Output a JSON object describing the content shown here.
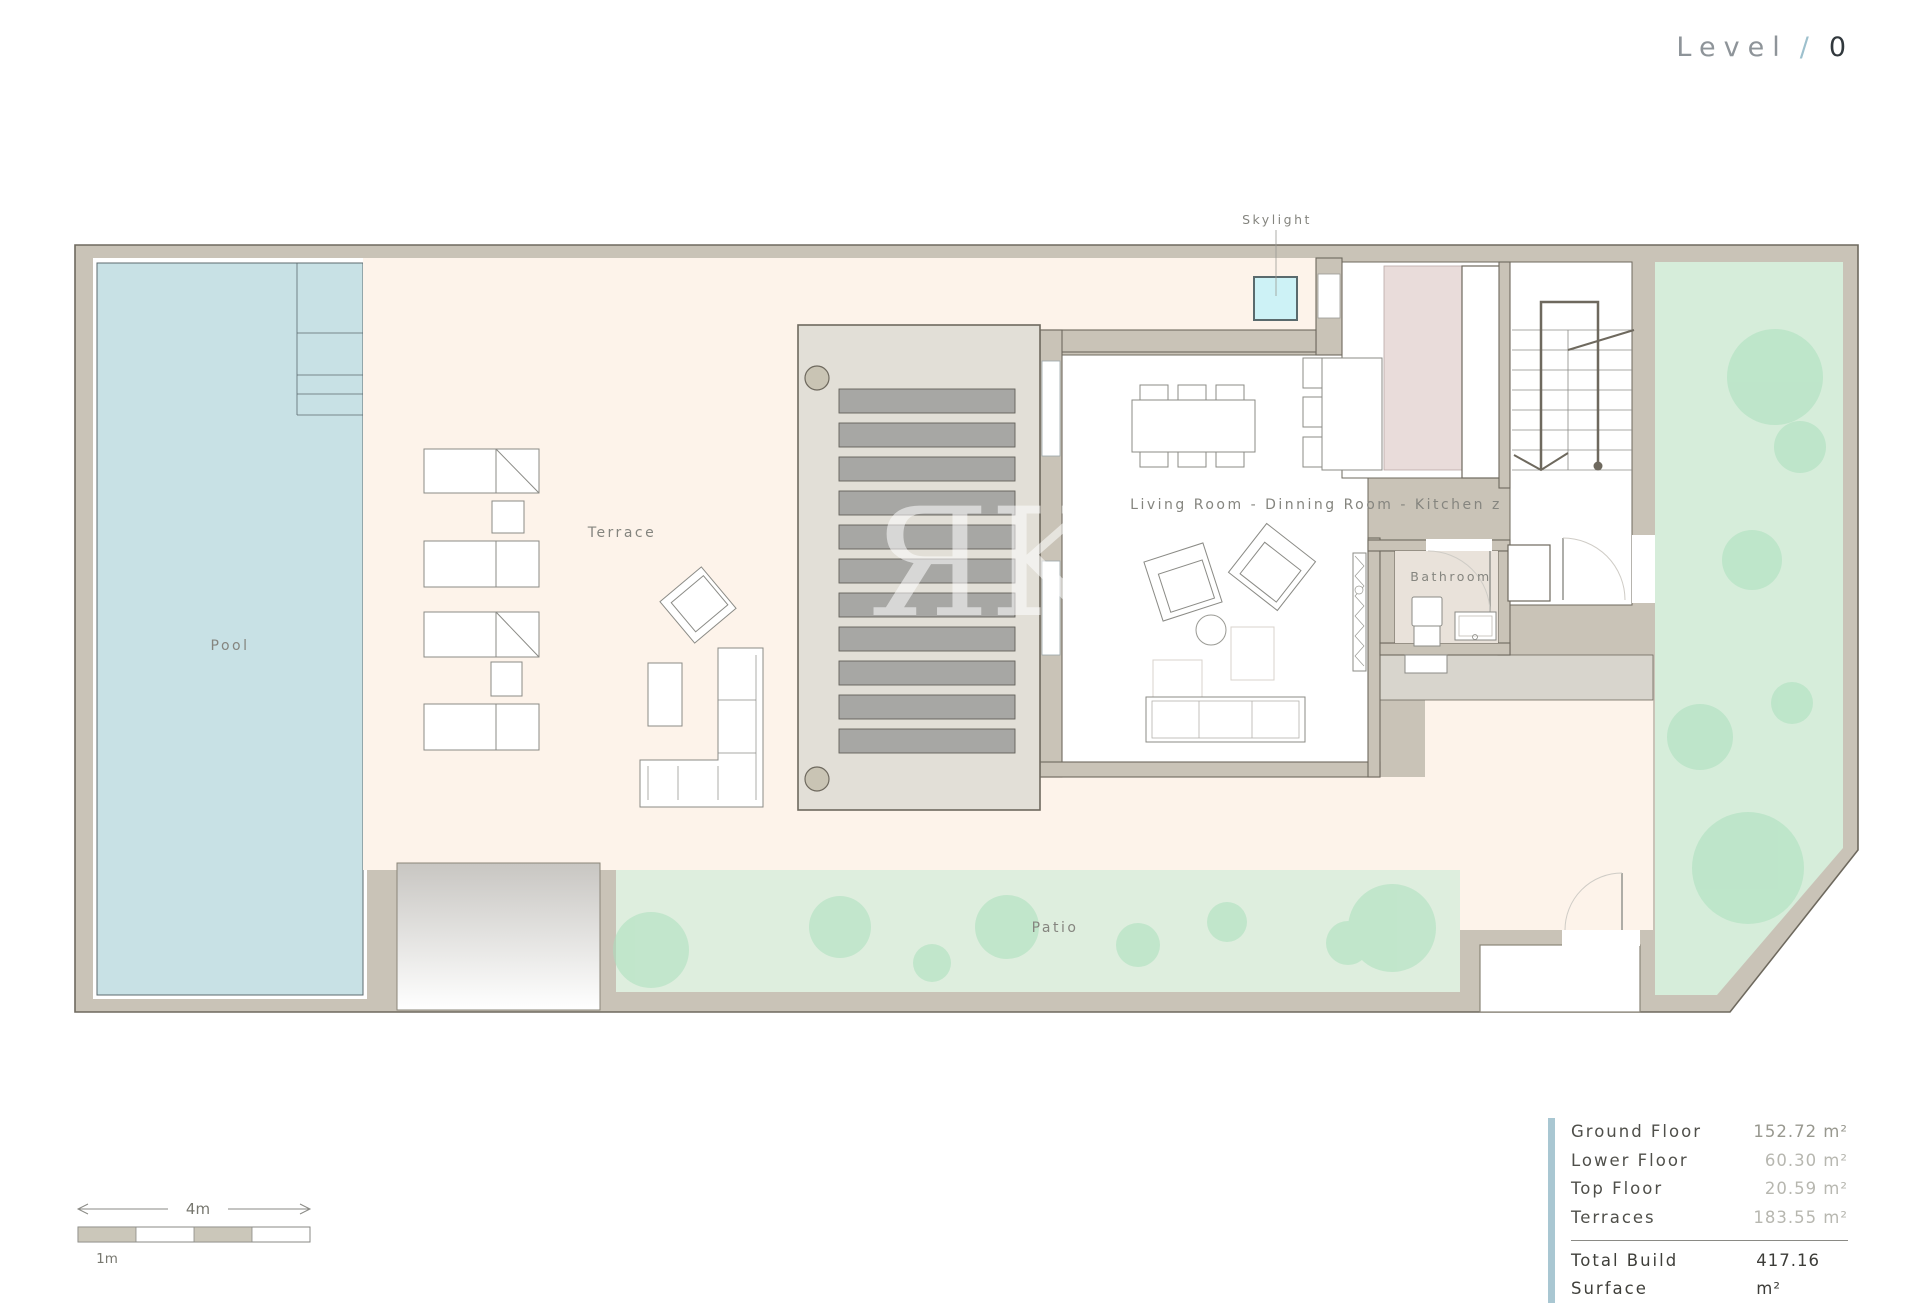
{
  "title": {
    "level_label": "Level",
    "separator": "/",
    "level_number": "0"
  },
  "plan": {
    "labels": {
      "skylight": "Skylight",
      "pool": "Pool",
      "terrace": "Terrace",
      "living": "Living Room - Dinning Room - Kitchen z",
      "bathroom": "Bathroom",
      "patio": "Patio"
    },
    "watermark": "ЯK"
  },
  "scale_bar": {
    "total_label": "4m",
    "unit_label": "1m"
  },
  "areas": {
    "rows": [
      {
        "label": "Ground Floor",
        "value": "152.72 m²"
      },
      {
        "label": "Lower Floor",
        "value": "60.30 m²"
      },
      {
        "label": "Top Floor",
        "value": "20.59 m²"
      },
      {
        "label": "Terraces",
        "value": "183.55 m²"
      }
    ],
    "total": {
      "label": "Total Build Surface",
      "value": "417.16 m²"
    }
  },
  "colors": {
    "wall": "#c9c3b7",
    "wall_outline": "#6e695e",
    "pool": "#c8e1e5",
    "terrace": "#fdf3ea",
    "patio": "#deeede",
    "garden": "#d6edda",
    "bush": "#abe0bd",
    "skylight": "#cdf2f6",
    "kitchen_counter": "#e9dcda",
    "bathroom_floor": "#e9e2da",
    "slat": "#a7a7a4",
    "accent_blue": "#a9c7d2"
  }
}
